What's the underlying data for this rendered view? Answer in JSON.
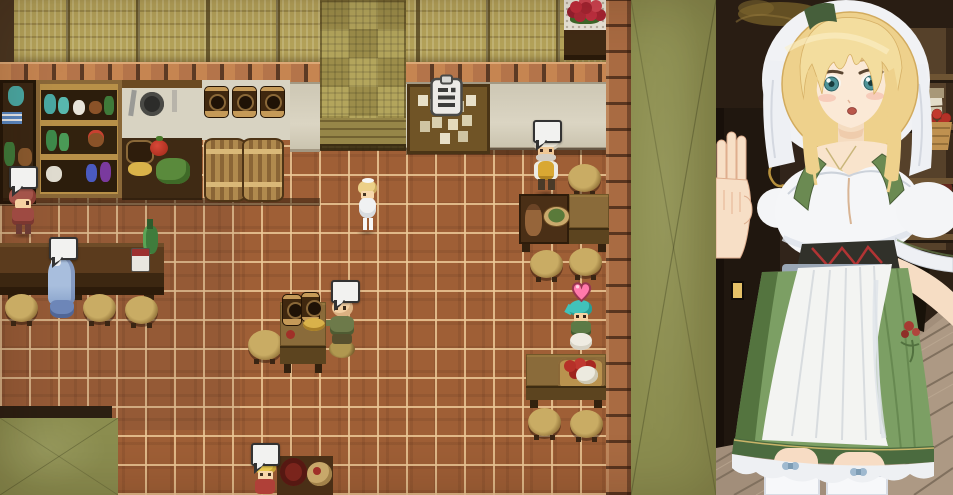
{
  "window": {
    "width": 953,
    "height": 495,
    "description": "Tavern interior RPG scene with barmaid portrait overlay"
  },
  "game_scene": {
    "characters": [
      {
        "id": "npc-red-hair",
        "desc": "Red-haired villager with speech bubble",
        "emote": "speech-bubble"
      },
      {
        "id": "npc-blue-robe",
        "desc": "Blue-robed patron seated at the bar counter",
        "emote": "speech-bubble"
      },
      {
        "id": "player-barmaid",
        "desc": "Blonde barmaid sprite (player character)",
        "emote": "none"
      },
      {
        "id": "npc-bald-patron",
        "desc": "Bald patron in green shirt seated by a keg table",
        "emote": "speech-bubble"
      },
      {
        "id": "npc-chef",
        "desc": "Grey-bearded chef in turban and yellow vest",
        "emote": "speech-bubble"
      },
      {
        "id": "npc-teal-hair",
        "desc": "Teal-haired patron dining, with heart emote",
        "emote": "heart"
      },
      {
        "id": "npc-blond-child",
        "desc": "Blond child at the lower table",
        "emote": "speech-bubble"
      }
    ],
    "emotes": {
      "speech_bubbles": 5,
      "hearts": 1
    },
    "icons": {
      "board": {
        "name": "clipboard-icon",
        "desc": "Notice board clipboard icon"
      },
      "bubble": {
        "name": "speech-bubble",
        "desc": "Blank speech balloon emote"
      },
      "heart": {
        "name": "heart-icon",
        "desc": "Pink heart affection emote"
      }
    },
    "props": [
      "potion shelves",
      "kitchen rack with pan",
      "hanging kegs",
      "wooden barrels",
      "vegetable crate",
      "notice board with papers",
      "rose bouquet table",
      "bar counter with bottle and mug",
      "dining tables with food",
      "round stools"
    ],
    "colors": {
      "floor_tile": "#9f5f36",
      "grout": "#ecc896",
      "wall_weave": "#b3a55c",
      "wall_plaster": "#d8d3c2",
      "brick": "#b5754a",
      "outside_green": "#8b8d4f",
      "wood_dark": "#4a2f16"
    }
  },
  "portrait": {
    "character": "Blonde barmaid in white veil and green dirndl with white apron",
    "emotion": "neutral",
    "colors": {
      "hair": "#eed18c",
      "eyes": "#4e9398",
      "veil": "#f1f2f5",
      "dirndl_green": "#7c9f64",
      "apron": "#f3f4f2",
      "lacing_red": "#b23434",
      "skin": "#f9e4cc"
    },
    "background": "Tavern shelves with apple basket, dark doorway and plank floor"
  }
}
